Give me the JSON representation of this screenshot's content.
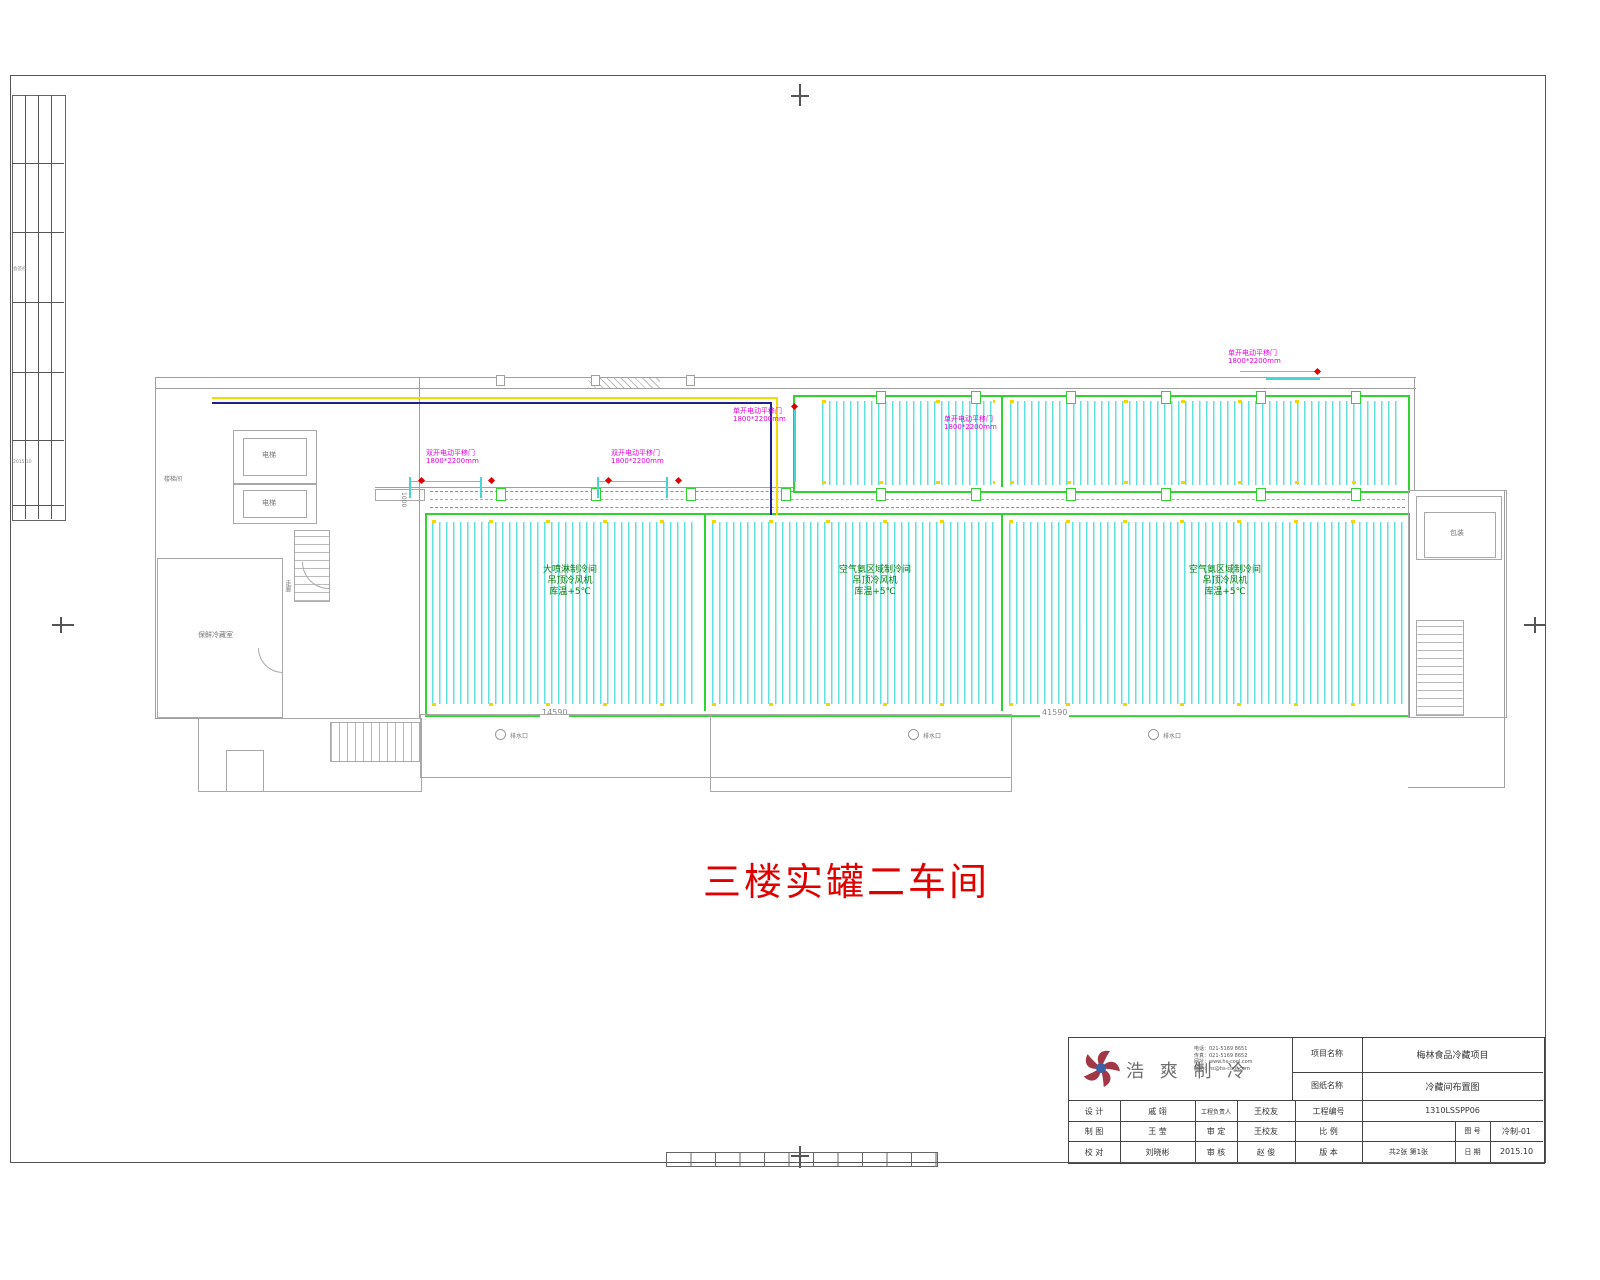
{
  "sheet": {
    "title": "三楼实罐二车间",
    "dim_left": "14590",
    "dim_right": "41590",
    "door_width_note": "1000",
    "sidebar_note1": "会签栏",
    "sidebar_note2": "2015.10"
  },
  "plan": {
    "rooms": {
      "stairwell": "楼梯间",
      "elevator1": "电梯",
      "elevator2": "电梯",
      "cold_room": "保鲜冷藏室",
      "corridor": "走廊",
      "packing": "包装"
    },
    "drains": [
      {
        "label": "排水口"
      },
      {
        "label": "排水口"
      },
      {
        "label": "排水口"
      }
    ],
    "door_labels": [
      {
        "line1": "双开电动平移门",
        "line2": "1800*2200mm"
      },
      {
        "line1": "双开电动平移门",
        "line2": "1800*2200mm"
      },
      {
        "line1": "单开电动平移门",
        "line2": "1800*2200mm"
      },
      {
        "line1": "单开电动平移门",
        "line2": "1800*2200mm"
      },
      {
        "line1": "单开电动平移门",
        "line2": "1800*2200mm"
      }
    ],
    "bay_labels": [
      {
        "l1": "大喷淋制冷间",
        "l2": "吊顶冷风机",
        "l3": "库温+5℃"
      },
      {
        "l1": "空气氨区域制冷间",
        "l2": "吊顶冷风机",
        "l3": "库温+5℃"
      },
      {
        "l1": "空气氨区域制冷间",
        "l2": "吊顶冷风机",
        "l3": "库温+5℃"
      }
    ]
  },
  "titleblock": {
    "company_name": "浩 爽 制 冷",
    "contact_line1": "电话：021-5169 8651",
    "contact_line2": "传真：021-5169 8652",
    "contact_line3": "网址：www.hs-cool.com",
    "contact_line4": "邮箱：hs@hs-cool.com",
    "project_label": "项目名称",
    "project_value": "梅林食品冷藏项目",
    "drawing_label": "图纸名称",
    "drawing_value": "冷藏间布置图",
    "design_label": "设 计",
    "design_value": "戚 翊",
    "draft_label": "制 图",
    "draft_value": "王 莹",
    "check_label": "校 对",
    "check_value": "刘晓彬",
    "pm_label": "工程负责人",
    "pm_value": "王校友",
    "approve_label": "审 定",
    "approve_value": "王校友",
    "review_label": "审 核",
    "review_value": "赵 俊",
    "projno_label": "工程编号",
    "projno_value": "1310LSSPP06",
    "scale_label": "比 例",
    "scale_value": "",
    "fig_label": "图 号",
    "fig_value": "冷制-01",
    "version_label": "版 本",
    "sheets_value": "共2张 第1张",
    "date_label": "日 期",
    "date_value": "2015.10"
  }
}
